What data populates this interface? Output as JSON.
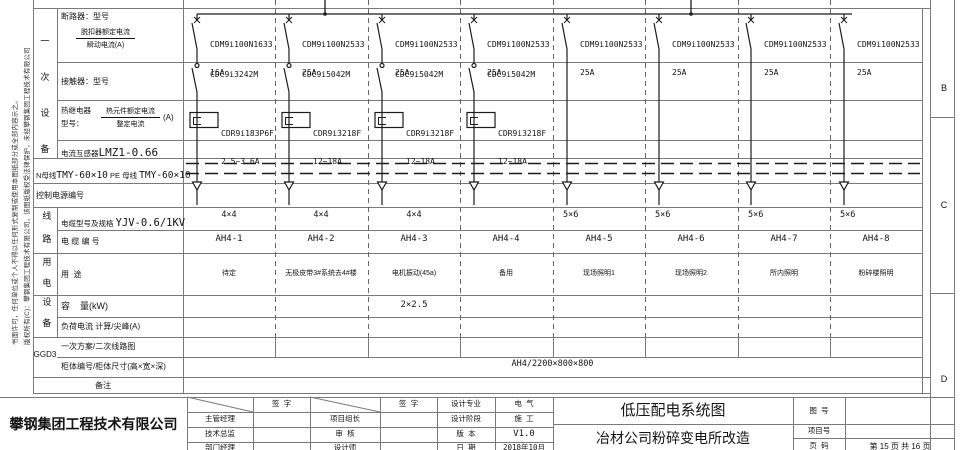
{
  "sheet": {
    "colors": {
      "line": "#1c1c1c",
      "grid": "#7a7a7a",
      "background": "#ffffff"
    }
  },
  "zone_markers": {
    "b": "B",
    "c": "C",
    "d": "D"
  },
  "side_note": {
    "line1": "版权所有(C)：攀钢集团工程技术有限公司，该图纸版权受法律保护，未经攀钢集团工程技术有限公司",
    "line2": "书面许可，任何单位或个人不得以任何形式复制或使用本图纸部分或全部内容示之。"
  },
  "categories": {
    "primary": "一次设备",
    "line": "线路",
    "power": "用电",
    "device": "设备",
    "note": "备注"
  },
  "panel": {
    "name": "GGD3",
    "scheme_label": "一次方案/二次线路图",
    "cabinet_label": "柜体编号/柜体尺寸(高×宽×深)",
    "cabinet_value": "AH4/2200×800×800"
  },
  "rows": {
    "breaker": {
      "title": "断路器：型号",
      "frac_top": "脱扣器额定电流",
      "frac_bottom": "瞬动电流(A)"
    },
    "contactor": {
      "title": "接触器：型号"
    },
    "thermal": {
      "title1": "热继电器",
      "title2": "型号：",
      "frac_top": "热元件额定电流",
      "frac_bottom": "整定电流",
      "unit": "(A)"
    },
    "ct": {
      "prefix": "电流互感器",
      "value": "LMZ1-0.66"
    },
    "nbus": {
      "p1": "N母线",
      "v1": "TMY-60×10",
      "p2": " PE 母线 ",
      "v2": "TMY-60×10"
    },
    "control": {
      "title": "控制电源编号"
    },
    "cable_spec": {
      "prefix": "电缆型号及规格 ",
      "value": "YJV-0.6/1KV"
    },
    "cable_no": {
      "title": "电 缆 编 号"
    },
    "usage": {
      "title": "用  途"
    },
    "capacity": {
      "title": "容    量(kW)"
    },
    "load": {
      "title": "负荷电流 计算/尖峰(A)"
    }
  },
  "circuits": [
    {
      "breaker_model": "CDM9i100N1633",
      "breaker_current": "16A",
      "contactor": "CDC9i3242M",
      "relay_model": "CDR9i183P6F",
      "relay_range": "2.5~3.6A",
      "cable_spec": "4×4",
      "cable_no": "AH4-1",
      "usage": "待定",
      "capacity": ""
    },
    {
      "breaker_model": "CDM9i100N2533",
      "breaker_current": "25A",
      "contactor": "CDC9i5042M",
      "relay_model": "CDR9i3218F",
      "relay_range": "12~18A",
      "cable_spec": "4×4",
      "cable_no": "AH4-2",
      "usage": "无极皮带3#系统去4#楼",
      "capacity": ""
    },
    {
      "breaker_model": "CDM9i100N2533",
      "breaker_current": "25A",
      "contactor": "CDC9i5042M",
      "relay_model": "CDR9i3218F",
      "relay_range": "12~18A",
      "cable_spec": "4×4",
      "cable_no": "AH4-3",
      "usage": "电机振动(45a)",
      "capacity": "2×2.5"
    },
    {
      "breaker_model": "CDM9i100N2533",
      "breaker_current": "25A",
      "contactor": "CDC9i5042M",
      "relay_model": "CDR9i3218F",
      "relay_range": "12~18A",
      "cable_spec": "",
      "cable_no": "AH4-4",
      "usage": "备用",
      "capacity": ""
    },
    {
      "breaker_model": "CDM9i100N2533",
      "breaker_current": "25A",
      "cable_spec": "5×6",
      "cable_no": "AH4-5",
      "usage": "现场照明1",
      "capacity": ""
    },
    {
      "breaker_model": "CDM9i100N2533",
      "breaker_current": "25A",
      "cable_spec": "5×6",
      "cable_no": "AH4-6",
      "usage": "现场照明2",
      "capacity": ""
    },
    {
      "breaker_model": "CDM9i100N2533",
      "breaker_current": "25A",
      "cable_spec": "5×6",
      "cable_no": "AH4-7",
      "usage": "所内照明",
      "capacity": ""
    },
    {
      "breaker_model": "CDM9i100N2533",
      "breaker_current": "25A",
      "cable_spec": "5×6",
      "cable_no": "AH4-8",
      "usage": "粉碎楼照明",
      "capacity": ""
    }
  ],
  "title_block": {
    "company": "攀钢集团工程技术有限公司",
    "sign_header": "签  字",
    "col1_rows": [
      "主管经理",
      "技术总监",
      "部门经理"
    ],
    "col2_rows": [
      "项目组长",
      "审  核",
      "设计师"
    ],
    "meta_labels": [
      "设计专业",
      "设计阶段",
      "版  本",
      "日  期"
    ],
    "meta_values": [
      "电  气",
      "施  工",
      "V1.0",
      "2018年10月"
    ],
    "drawing_title": "低压配电系统图",
    "project_title": "冶材公司粉碎变电所改造",
    "drawing_no_label": "图  号",
    "project_no_label": "项目号",
    "page_label": "页  码",
    "page_value": "第 15 页 共 16 页"
  }
}
